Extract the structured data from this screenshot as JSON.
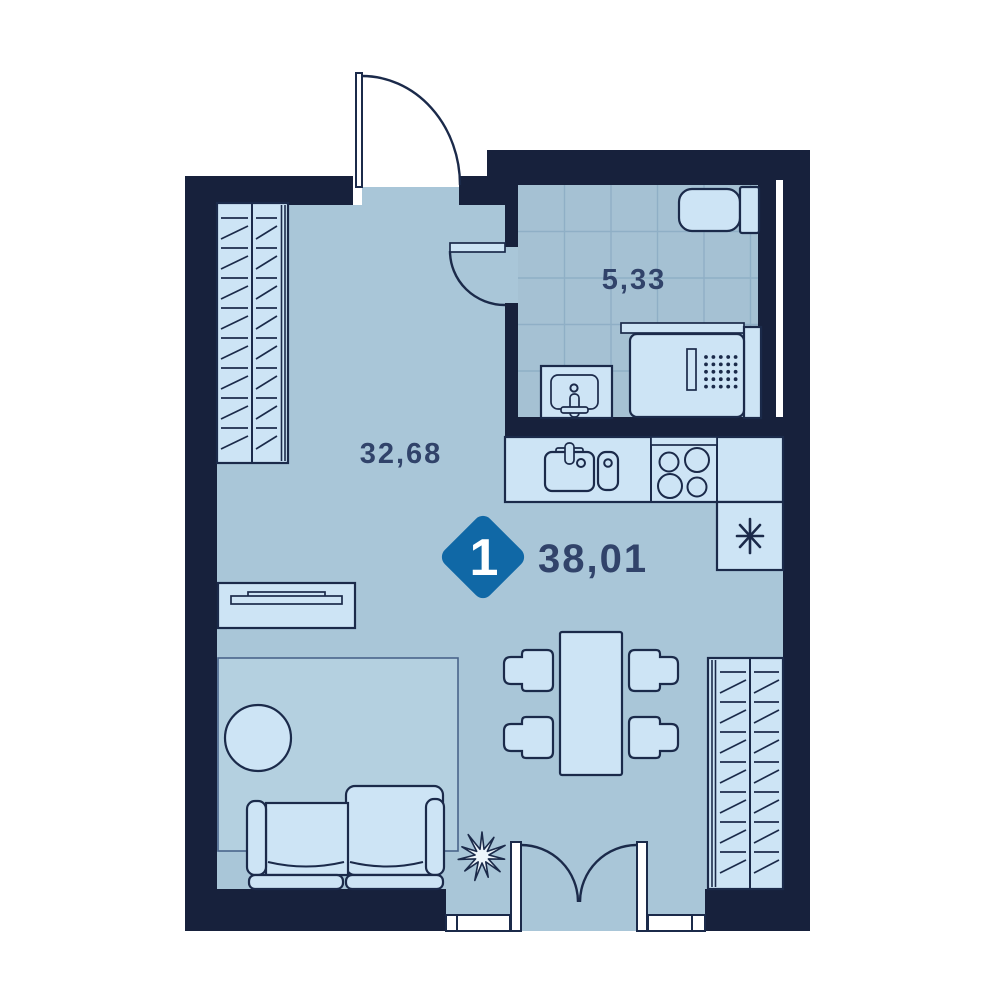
{
  "floorplan": {
    "rooms_badge": "1",
    "areas": {
      "total": "38,01",
      "living_room": "32,68",
      "bathroom": "5,33"
    },
    "colors": {
      "wall": "#17213C",
      "floor": "#A9C6D8",
      "bathroom_floor": "#A5C1D3",
      "furniture": "#CDE4F5",
      "rug": "#B4D0E0",
      "accent": "#1068A6",
      "label_text": "#31436A",
      "tile_line": "#8FAFC6",
      "badge_text": "#FFFFFF",
      "background": "#FFFFFF"
    },
    "icons": {
      "fridge": "snowflake-asterisk",
      "plant": "plant-starburst"
    }
  }
}
